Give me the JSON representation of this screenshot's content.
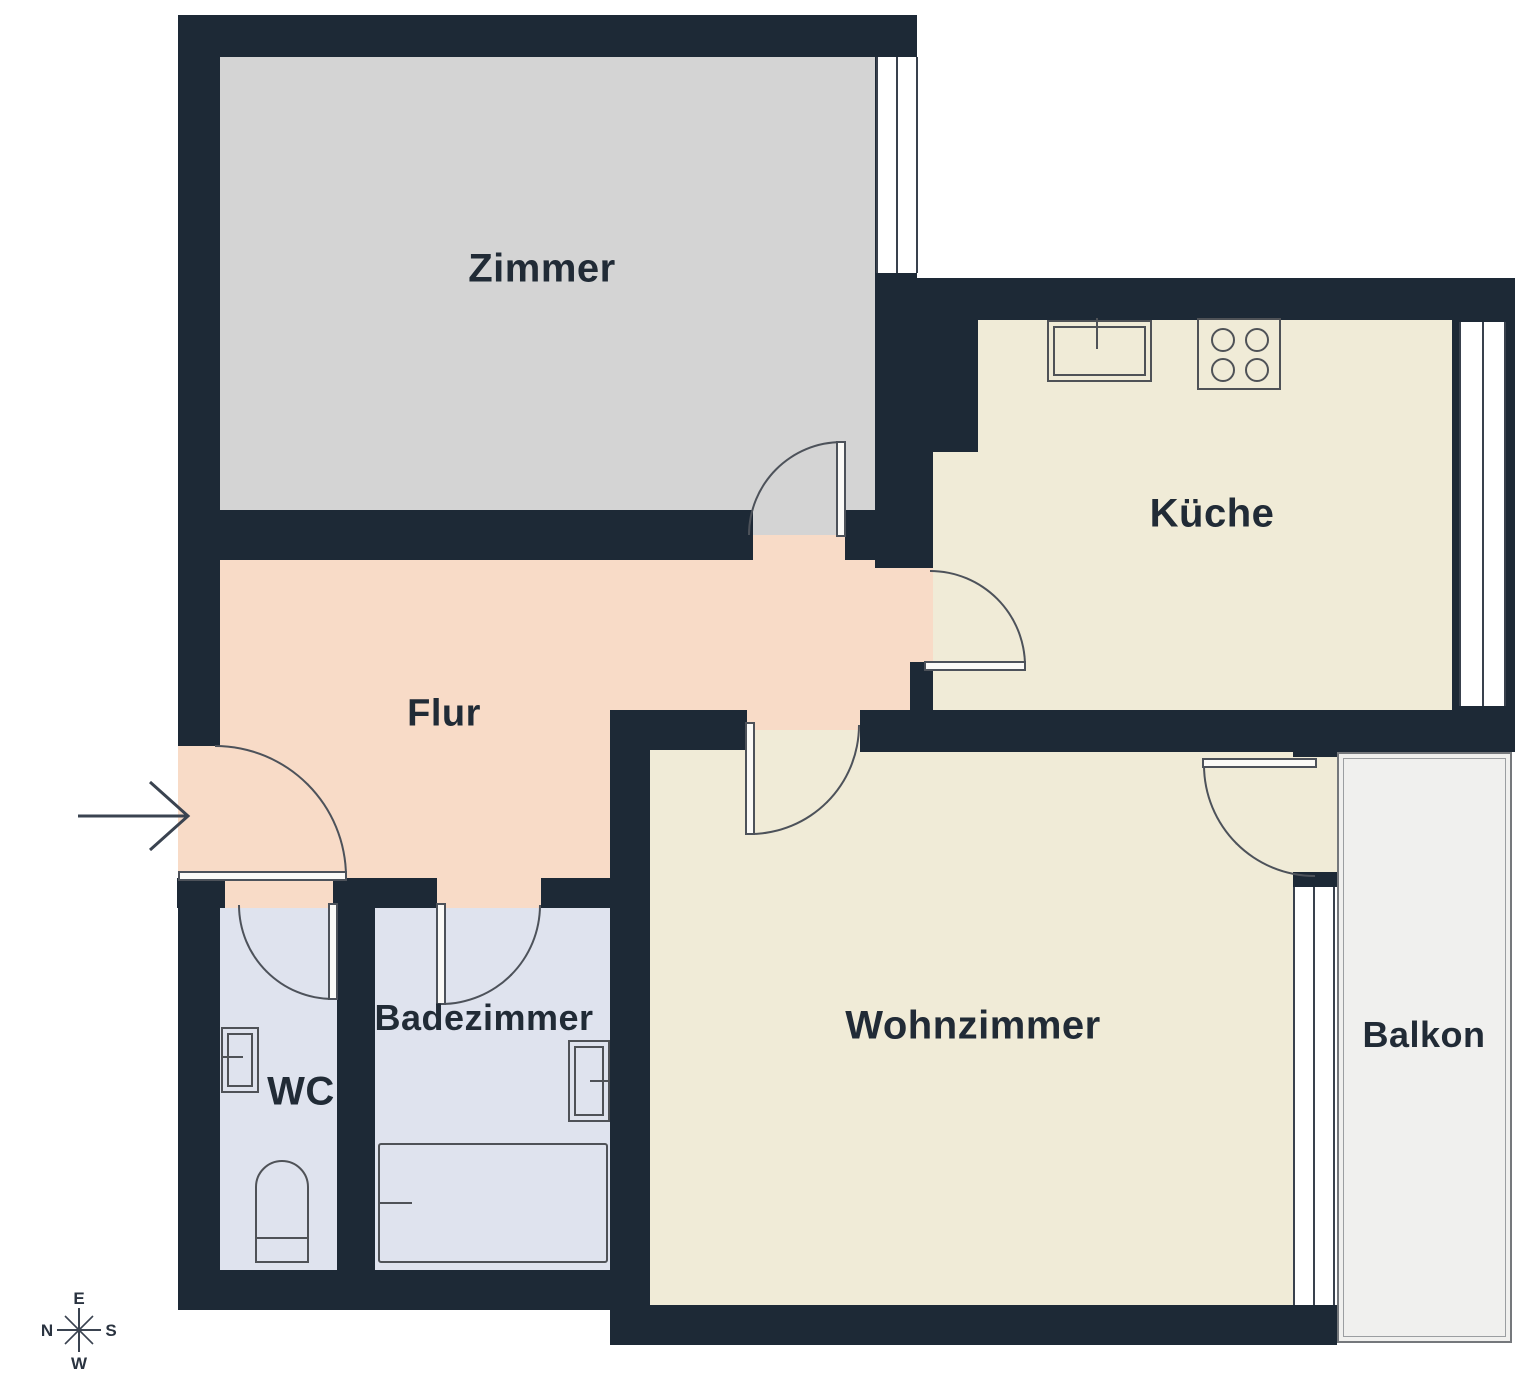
{
  "floorplan": {
    "type": "apartment-floor-plan",
    "wall_color": "#1d2936",
    "rooms": [
      {
        "id": "zimmer",
        "label": "Zimmer",
        "color": "#d4d4d4"
      },
      {
        "id": "kueche",
        "label": "Küche",
        "color": "#f0ebd7"
      },
      {
        "id": "flur",
        "label": "Flur",
        "color": "#f8dbc7"
      },
      {
        "id": "wc",
        "label": "WC",
        "color": "#dfe3ee"
      },
      {
        "id": "badezimmer",
        "label": "Badezimmer",
        "color": "#dfe3ee"
      },
      {
        "id": "wohnzimmer",
        "label": "Wohnzimmer",
        "color": "#f0ebd7"
      },
      {
        "id": "balkon",
        "label": "Balkon",
        "color": "#f0f0ee"
      }
    ],
    "compass": {
      "top": "E",
      "left": "N",
      "right": "S",
      "bottom": "W"
    },
    "entrance_marker": {
      "symbol": "→",
      "meaning": "entrance-direction"
    },
    "fixtures": [
      "kitchen-sink-icon",
      "stove-icon",
      "wc-sink-icon",
      "toilet-icon",
      "bath-sink-icon",
      "bathtub-icon"
    ],
    "windows": [
      "zimmer-window",
      "kueche-window",
      "wohnzimmer-window"
    ],
    "doors": [
      "entrance-door",
      "zimmer-door",
      "kueche-door",
      "wohnzimmer-door",
      "balkon-door",
      "wc-door",
      "badezimmer-door"
    ]
  }
}
